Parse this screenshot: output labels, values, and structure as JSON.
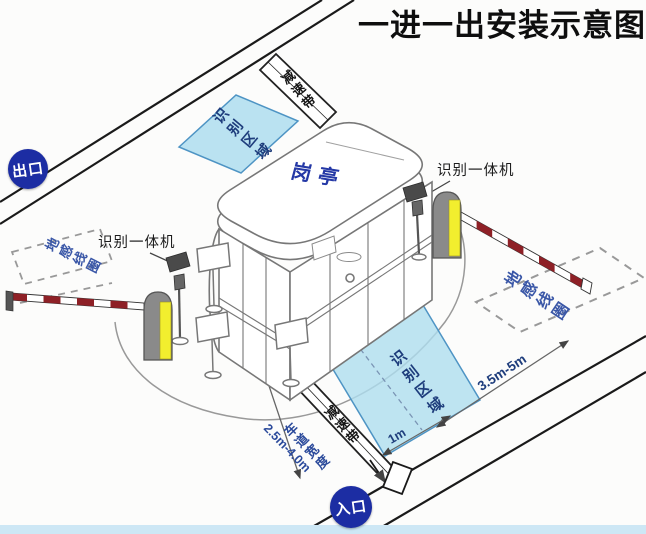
{
  "title": "一进一出安装示意图",
  "badges": {
    "exit": "出口",
    "entrance": "入口"
  },
  "booth": {
    "label": "岗亭"
  },
  "zones": {
    "recognition": "识别区域",
    "speed_bump": "减速带",
    "ground_loop": "地感线圈"
  },
  "devices": {
    "recognition_machine": "识别一体机"
  },
  "dimensions": {
    "approach_distance": "3.5m-5m",
    "stop_offset": "1m",
    "lane_width_label": "车道宽度",
    "lane_width_value": "2.5m-4.0m"
  },
  "colors": {
    "badge_blue": "#1c2da3",
    "zone_fill": "#aeddef",
    "zone_border": "#4e94c4",
    "label_navy": "#1e3d7c",
    "loop_text_blue": "#3a57a7",
    "dim_text_blue": "#2b4a9b",
    "booth_label_blue": "#2438a6",
    "barrier_yellow": "#f2ee2e",
    "arm_red": "#8e2026"
  }
}
